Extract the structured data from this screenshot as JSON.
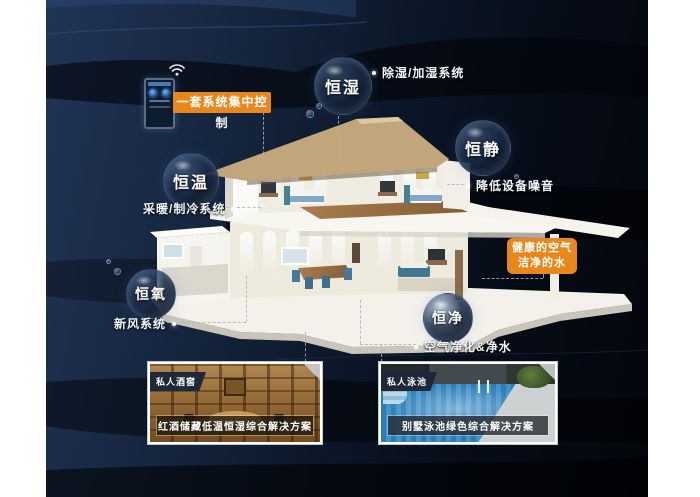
{
  "poster": {
    "accent_color": "#e8871b",
    "background_color": "#0c1626"
  },
  "control_panel": {
    "label": "一套系统集中控制",
    "wifi_icon": "wifi-icon"
  },
  "features": [
    {
      "bubble": "恒湿",
      "description": "除湿/加湿系统"
    },
    {
      "bubble": "恒静",
      "description": "降低设备噪音"
    },
    {
      "bubble": "恒温",
      "description": "采暖/制冷系统"
    },
    {
      "bubble": "恒氧",
      "description": "新风系统"
    },
    {
      "bubble": "恒净",
      "description": "空气净化&净水"
    }
  ],
  "benefit_box": {
    "line1": "健康的空气",
    "line2": "洁净的水"
  },
  "gallery": [
    {
      "badge": "私人酒窖",
      "caption": "红酒储藏低温恒湿综合解决方案"
    },
    {
      "badge": "私人泳池",
      "caption": "别墅泳池绿色综合解决方案"
    }
  ]
}
